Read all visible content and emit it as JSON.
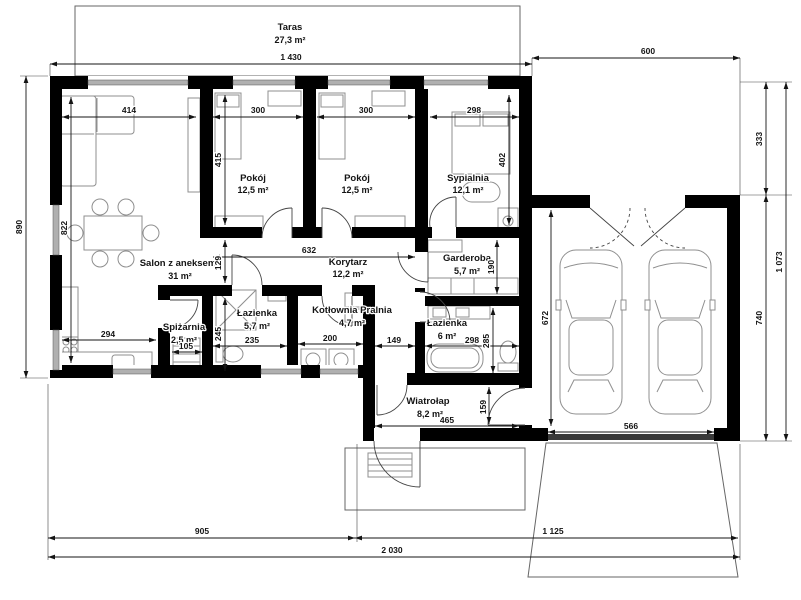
{
  "plan": {
    "rooms": [
      {
        "name": "Taras",
        "area": "27,3 m²"
      },
      {
        "name": "Salon z aneksem",
        "area": "31 m²"
      },
      {
        "name": "Pokój",
        "area": "12,5 m²"
      },
      {
        "name": "Pokój",
        "area": "12,5 m²"
      },
      {
        "name": "Sypialnia",
        "area": "12,1 m²"
      },
      {
        "name": "Korytarz",
        "area": "12,2 m²"
      },
      {
        "name": "Garderoba",
        "area": "5,7 m²"
      },
      {
        "name": "Spiżarnia",
        "area": "2,5 m²"
      },
      {
        "name": "Łazienka",
        "area": "5,7 m²"
      },
      {
        "name": "Kotłownia Pralnia",
        "area": "4,7 m²"
      },
      {
        "name": "Łazienka",
        "area": "6 m²"
      },
      {
        "name": "Wiatrołap",
        "area": "8,2 m²"
      }
    ],
    "dims": {
      "d1430": "1 430",
      "d600": "600",
      "d890": "890",
      "d333": "333",
      "d740": "740",
      "d1073": "1 073",
      "d905": "905",
      "d1125": "1 125",
      "d2030": "2 030",
      "d414": "414",
      "d300a": "300",
      "d300b": "300",
      "d298a": "298",
      "d822": "822",
      "d415": "415",
      "d402": "402",
      "d632": "632",
      "d129": "129",
      "d190": "190",
      "d294": "294",
      "d105": "105",
      "d245": "245",
      "d235": "235",
      "d200": "200",
      "d149": "149",
      "d298b": "298",
      "d285": "285",
      "d465": "465",
      "d159": "159",
      "d672": "672",
      "d566": "566"
    },
    "colors": {
      "wall": "#000000",
      "window": "#b0b0b0",
      "furniture": "#8f8f8f",
      "dimension": "#141414"
    }
  }
}
